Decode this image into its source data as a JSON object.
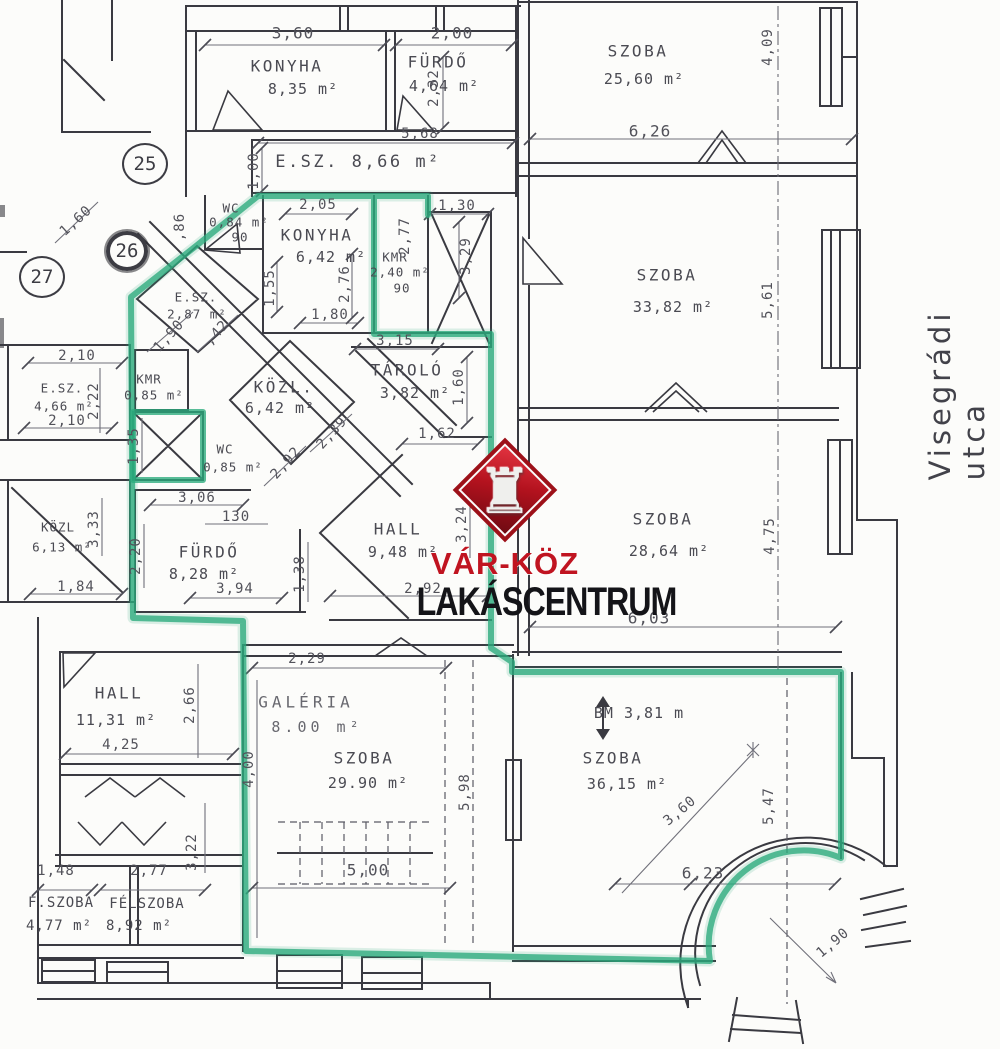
{
  "street": "Visegrádi utca",
  "logo": {
    "top": "VÁR-KÖZ",
    "bottom": "LAKÁSCENTRUM",
    "diamond_color": "#b3121e",
    "rook_icon": "♜"
  },
  "accent_green": "#2aaa7c",
  "circles": [
    "25",
    "26",
    "27"
  ],
  "rooms": [
    {
      "name": "KONYHA",
      "area": "8,35 m²"
    },
    {
      "name": "FÜRDŐ",
      "area": "4,64 m²"
    },
    {
      "name": "E.SZ.",
      "area": "8,66 m²"
    },
    {
      "name": "WC",
      "area": "0,84 m²",
      "extra": "90"
    },
    {
      "name": "KONYHA",
      "area": "6,42 m²"
    },
    {
      "name": "KMR",
      "area": "2,40 m²",
      "extra": "90"
    },
    {
      "name": "E.SZ.",
      "area": "2,87 m²"
    },
    {
      "name": "E.SZ.",
      "area": "4,66 m²"
    },
    {
      "name": "KMR",
      "area": "0,85 m²"
    },
    {
      "name": "WC",
      "area": "0,85 m²"
    },
    {
      "name": "KÖZL.",
      "area": "6,42 m²"
    },
    {
      "name": "TÁROLÓ",
      "area": "3,82 m²"
    },
    {
      "name": "KÖZL",
      "area": "6,13 m²"
    },
    {
      "name": "FÜRDŐ",
      "area": "8,28 m²"
    },
    {
      "name": "HALL",
      "area": "9,48 m²"
    },
    {
      "name": "SZOBA",
      "area": "25,60 m²"
    },
    {
      "name": "SZOBA",
      "area": "33,82 m²"
    },
    {
      "name": "SZOBA",
      "area": "28,64 m²"
    },
    {
      "name": "HALL",
      "area": "11,31 m²"
    },
    {
      "name": "GALÉRIA",
      "area": "8.00 m²"
    },
    {
      "name": "SZOBA",
      "area": "29.90 m²"
    },
    {
      "name": "SZOBA",
      "area": "36,15 m²",
      "extra": "BM 3,81 m"
    },
    {
      "name": "F.SZOBA",
      "area": "4,77 m²"
    },
    {
      "name": "FÉLSZOBA",
      "area": "8,92 m²"
    }
  ],
  "dims": [
    "3,60",
    "2,00",
    "2,32",
    "5,68",
    "1,00",
    "2,05",
    "1,30",
    "2,77",
    "3,29",
    "1,80",
    "1,55",
    "2,76",
    "3,15",
    "1,60",
    ",86",
    "1,90",
    ",42",
    "2,10",
    "2,22",
    "2,10",
    "1,35",
    "3,06",
    "130",
    "2,39",
    "2,92",
    "1,60",
    "1,62",
    "3,33",
    "1,84",
    "2,20",
    "3,94",
    "2,92",
    "1,38",
    "3,24",
    "6,26",
    "4,09",
    "5,61",
    "4,75",
    "6,03",
    "2,66",
    "4,25",
    "2,29",
    "4,00",
    "5,98",
    "5,00",
    "5,47",
    "3,60",
    "6,23",
    "1,90",
    "1,48",
    "2,77",
    "3,22"
  ]
}
